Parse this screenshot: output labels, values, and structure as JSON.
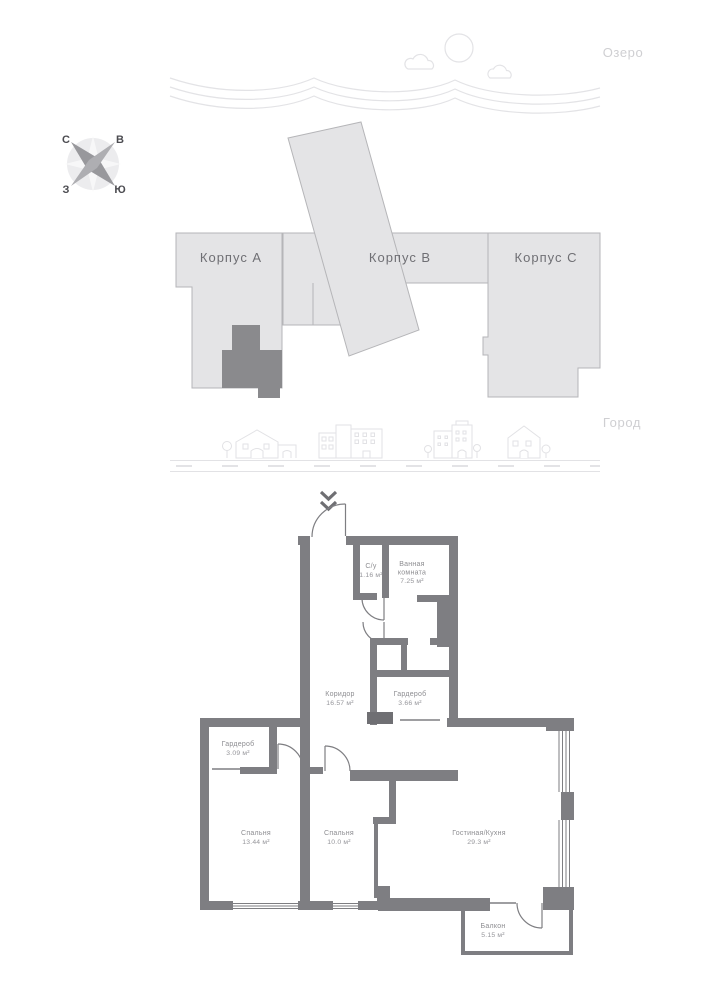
{
  "site": {
    "lake_label": "Озеро",
    "city_label": "Город",
    "compass": {
      "north": "С",
      "east": "В",
      "west": "З",
      "south": "Ю"
    },
    "buildings": [
      {
        "label": "Корпус А"
      },
      {
        "label": "Корпус В"
      },
      {
        "label": "Корпус С"
      }
    ]
  },
  "plan": {
    "rooms": [
      {
        "name": "С/у",
        "area": "1.16 м²"
      },
      {
        "name": "Ванная",
        "name2": "комната",
        "area": "7.25 м²"
      },
      {
        "name": "Коридор",
        "area": "16.57 м²"
      },
      {
        "name": "Гардероб",
        "area": "3.66 м²"
      },
      {
        "name": "Гардероб",
        "area": "3.09 м²"
      },
      {
        "name": "Спальня",
        "area": "13.44 м²"
      },
      {
        "name": "Спальня",
        "area": "10.0 м²"
      },
      {
        "name": "Гостиная/Кухня",
        "area": "29.3 м²"
      },
      {
        "name": "Балкон",
        "area": "5.15 м²"
      }
    ]
  },
  "colors": {
    "building_fill": "#e4e4e6",
    "building_stroke": "#b5b5b8",
    "highlight_apartment": "#8a8a8d",
    "wall": "#7e7e82",
    "sketch_line": "#e3e3e6",
    "muted_label": "#cfcfd2",
    "building_label": "#6f6f74",
    "room_label": "#8d8d91"
  }
}
